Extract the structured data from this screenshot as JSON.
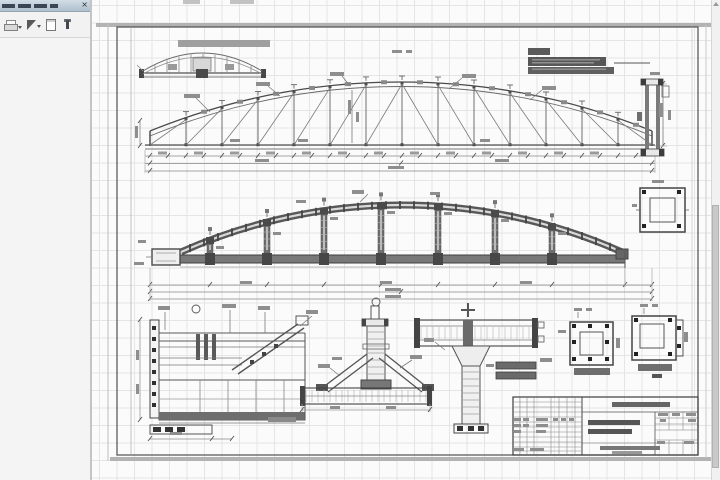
{
  "panel": {
    "title_text": "",
    "close_label": "×",
    "toolbar_icons": [
      {
        "name": "print-icon",
        "dropdown": true
      },
      {
        "name": "cursor-icon",
        "dropdown": true
      },
      {
        "name": "page-icon",
        "dropdown": false
      },
      {
        "name": "pin-icon",
        "dropdown": false
      }
    ]
  },
  "canvas": {
    "grid_visible": true,
    "scrollbar": {
      "orientation": "vertical",
      "thumb_top_px": 205,
      "thumb_height_px": 263
    }
  },
  "sheet": {
    "views": [
      {
        "name": "top-chord-plan",
        "label_highlighted": true
      },
      {
        "name": "truss-elevation-geometry"
      },
      {
        "name": "truss-elevation-sections",
        "annotation_selected": true
      },
      {
        "name": "column-member-detail"
      },
      {
        "name": "gusset-plate-section"
      },
      {
        "name": "end-support-detail"
      },
      {
        "name": "post-node-detail"
      },
      {
        "name": "t-joint-detail"
      },
      {
        "name": "base-plate-section-1"
      },
      {
        "name": "base-plate-section-2"
      },
      {
        "name": "title-block"
      }
    ],
    "colors": {
      "line": "#4a4a4a",
      "line_light": "#8e8e8e",
      "selection": "#5a5a5a",
      "label_highlight": "#9f9f9f",
      "paper_edge": "#b3b3b3"
    }
  }
}
